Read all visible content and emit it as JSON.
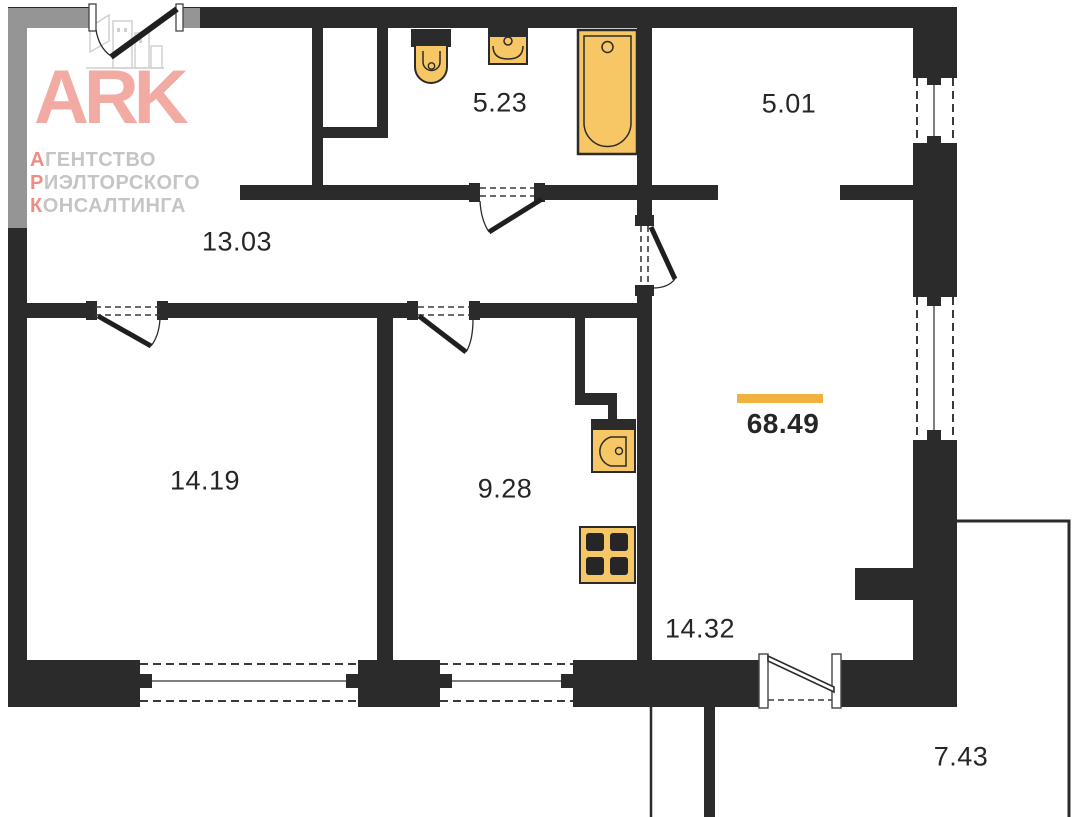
{
  "plan": {
    "total_area_label": "68.49",
    "rooms": {
      "bathroom": {
        "area": "5.23"
      },
      "wardrobe": {
        "area": "5.01"
      },
      "hallway": {
        "area": "13.03"
      },
      "bedroom": {
        "area": "14.19"
      },
      "kitchen": {
        "area": "9.28"
      },
      "living_room": {
        "area": "14.32"
      },
      "balcony": {
        "area": "7.43"
      }
    }
  },
  "logo": {
    "brand": "ARK",
    "lines": [
      {
        "lead": "А",
        "rest": "ГЕНТСТВО"
      },
      {
        "lead": "Р",
        "rest": "ИЭЛТОРСКОГО"
      },
      {
        "lead": "К",
        "rest": "ОНСАЛТИНГА"
      }
    ]
  },
  "colors": {
    "wall": "#2b2b2b",
    "fixture_fill": "#f7c765",
    "fixture_stroke": "#2b2b2b",
    "accent_bar": "#f2b240",
    "logo_brand": "#f2aba3",
    "logo_lead": "#ed8e85",
    "logo_gray": "#c5c5c5",
    "label_text": "#262626"
  }
}
